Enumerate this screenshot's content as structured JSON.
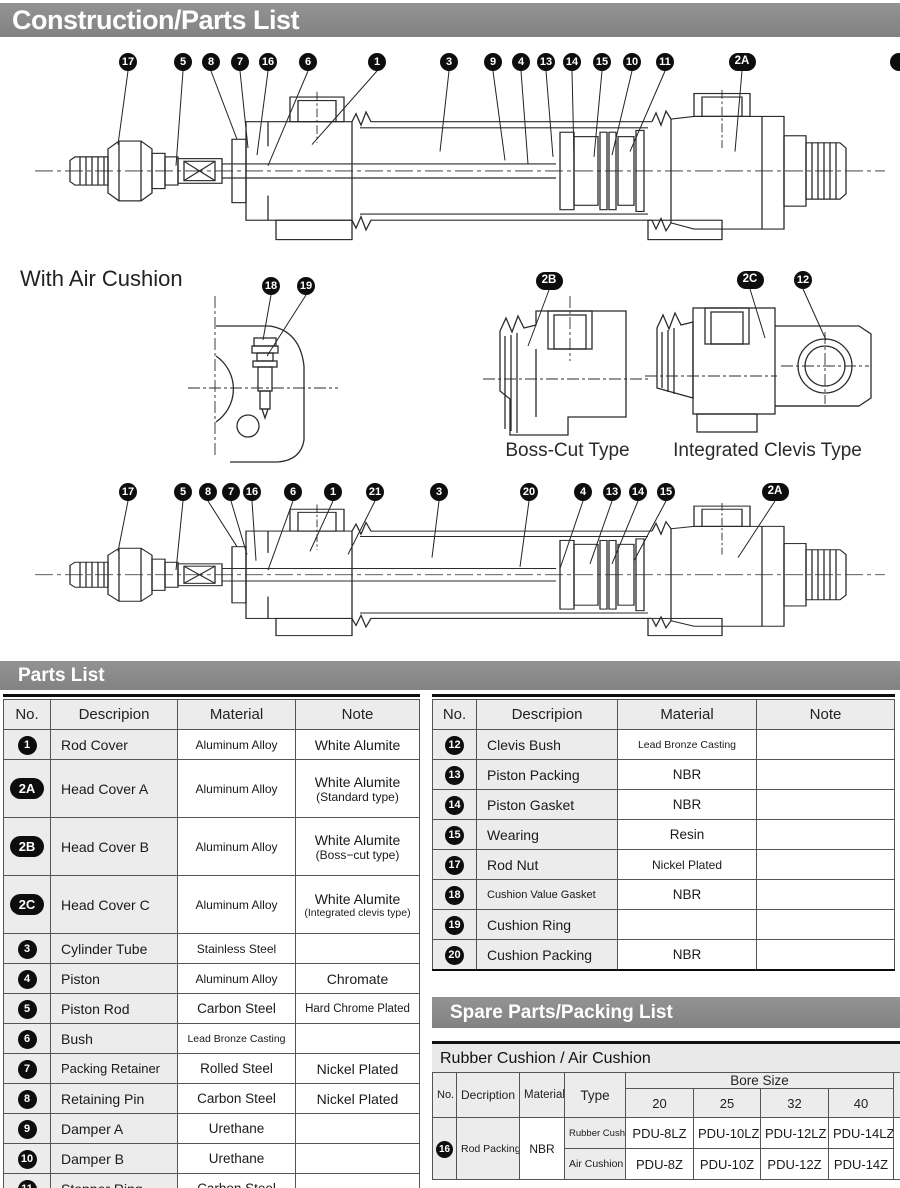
{
  "header": {
    "title": "Construction/Parts List"
  },
  "labels": {
    "with_air_cushion": "With Air Cushion",
    "boss_cut_caption": "Boss-Cut Type",
    "clevis_caption": "Integrated Clevis Type"
  },
  "diagrams": {
    "standard_callouts": [
      "17",
      "5",
      "8",
      "7",
      "16",
      "6",
      "1",
      "3",
      "9",
      "4",
      "13",
      "14",
      "15",
      "10",
      "11",
      "2A"
    ],
    "air_cushion_callouts": [
      "17",
      "5",
      "8",
      "7",
      "16",
      "6",
      "1",
      "21",
      "3",
      "20",
      "4",
      "13",
      "14",
      "15",
      "2A"
    ],
    "air_cushion_detail_callouts": [
      "18",
      "19"
    ],
    "boss_cut_callouts": [
      "2B"
    ],
    "clevis_callouts": [
      "2C",
      "12"
    ]
  },
  "parts_list": {
    "section_title": "Parts List",
    "columns": [
      "No.",
      "Descripion",
      "Material",
      "Note"
    ],
    "left_rows": [
      {
        "no": "1",
        "desc": "Rod Cover",
        "material": "Aluminum Alloy",
        "note": "White Alumite",
        "note2": ""
      },
      {
        "no": "2A",
        "desc": "Head Cover A",
        "material": "Aluminum Alloy",
        "note": "White Alumite",
        "note2": "(Standard type)"
      },
      {
        "no": "2B",
        "desc": "Head Cover B",
        "material": "Aluminum Alloy",
        "note": "White Alumite",
        "note2": "(Boss−cut type)"
      },
      {
        "no": "2C",
        "desc": "Head Cover C",
        "material": "Aluminum Alloy",
        "note": "White Alumite",
        "note2": "(Integrated clevis type)"
      },
      {
        "no": "3",
        "desc": "Cylinder Tube",
        "material": "Stainless Steel",
        "note": "",
        "note2": ""
      },
      {
        "no": "4",
        "desc": "Piston",
        "material": "Aluminum Alloy",
        "note": "Chromate",
        "note2": ""
      },
      {
        "no": "5",
        "desc": "Piston Rod",
        "material": "Carbon Steel",
        "note": "Hard Chrome Plated",
        "note2": ""
      },
      {
        "no": "6",
        "desc": "Bush",
        "material": "Lead Bronze Casting",
        "note": "",
        "note2": ""
      },
      {
        "no": "7",
        "desc": "Packing Retainer",
        "material": "Rolled Steel",
        "note": "Nickel Plated",
        "note2": ""
      },
      {
        "no": "8",
        "desc": "Retaining Pin",
        "material": "Carbon Steel",
        "note": "Nickel Plated",
        "note2": ""
      },
      {
        "no": "9",
        "desc": "Damper A",
        "material": "Urethane",
        "note": "",
        "note2": ""
      },
      {
        "no": "10",
        "desc": "Damper B",
        "material": "Urethane",
        "note": "",
        "note2": ""
      },
      {
        "no": "11",
        "desc": "Stopper Ring",
        "material": "Carbon Steel",
        "note": "",
        "note2": ""
      }
    ],
    "right_rows": [
      {
        "no": "12",
        "desc": "Clevis Bush",
        "material": "Lead Bronze Casting",
        "note": "",
        "note2": ""
      },
      {
        "no": "13",
        "desc": "Piston Packing",
        "material": "NBR",
        "note": "",
        "note2": ""
      },
      {
        "no": "14",
        "desc": "Piston Gasket",
        "material": "NBR",
        "note": "",
        "note2": ""
      },
      {
        "no": "15",
        "desc": "Wearing",
        "material": "Resin",
        "note": "",
        "note2": ""
      },
      {
        "no": "17",
        "desc": "Rod Nut",
        "material": "Nickel Plated",
        "note": "",
        "note2": ""
      },
      {
        "no": "18",
        "desc": "Cushion Value Gasket",
        "material": "NBR",
        "note": "",
        "note2": ""
      },
      {
        "no": "19",
        "desc": "Cushion Ring",
        "material": "",
        "note": "",
        "note2": ""
      },
      {
        "no": "20",
        "desc": "Cushion Packing",
        "material": "NBR",
        "note": "",
        "note2": ""
      }
    ]
  },
  "spare_parts": {
    "section_title": "Spare Parts/Packing List",
    "subsection_title": "Rubber Cushion / Air Cushion",
    "columns": [
      "No.",
      "Decription",
      "Material",
      "Type"
    ],
    "bore_size_label": "Bore Size",
    "bore_sizes": [
      "20",
      "25",
      "32",
      "40"
    ],
    "row": {
      "no": "16",
      "desc": "Rod Packing",
      "material": "NBR",
      "types": [
        {
          "label": "Rubber Cushion",
          "values": [
            "PDU-8LZ",
            "PDU-10LZ",
            "PDU-12LZ",
            "PDU-14LZ"
          ]
        },
        {
          "label": "Air Cushion",
          "values": [
            "PDU-8Z",
            "PDU-10Z",
            "PDU-12Z",
            "PDU-14Z"
          ]
        }
      ]
    }
  },
  "colors": {
    "section_bar": "#8a8a8a",
    "band_bg": "#e9e9e9",
    "row_shaded": "#ececec",
    "badge": "#0d0d0d",
    "line_art": "#2b2b2b"
  }
}
